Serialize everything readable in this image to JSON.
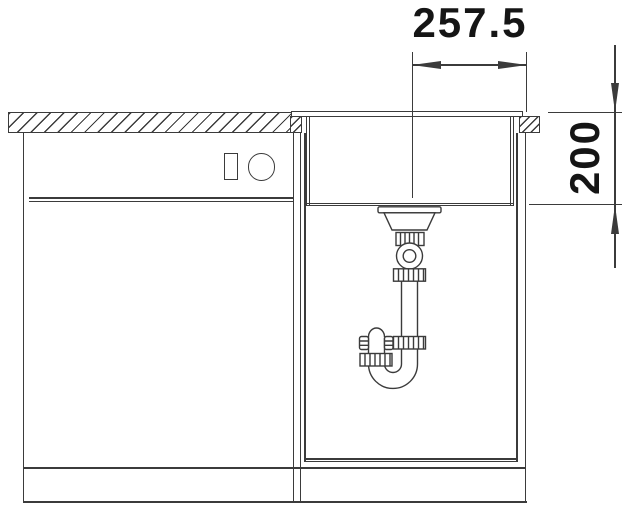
{
  "meta": {
    "type": "technical-drawing",
    "subject": "kitchen sink base cabinet front-view section with bowl and drain siphon"
  },
  "colors": {
    "background": "#ffffff",
    "line": "#3b3b3b",
    "text": "#151515"
  },
  "dimensions": {
    "drain_center_to_right_edge": {
      "label": "257.5",
      "orientation": "horizontal"
    },
    "bowl_depth": {
      "label": "200",
      "orientation": "vertical"
    }
  },
  "components": [
    "worktop-cross-section",
    "left-base-cabinet",
    "appliance-front-controls",
    "right-base-cabinet",
    "sink-rim",
    "sink-bowl",
    "basket-strainer",
    "tailpipe",
    "siphon-p-trap",
    "plinth"
  ]
}
